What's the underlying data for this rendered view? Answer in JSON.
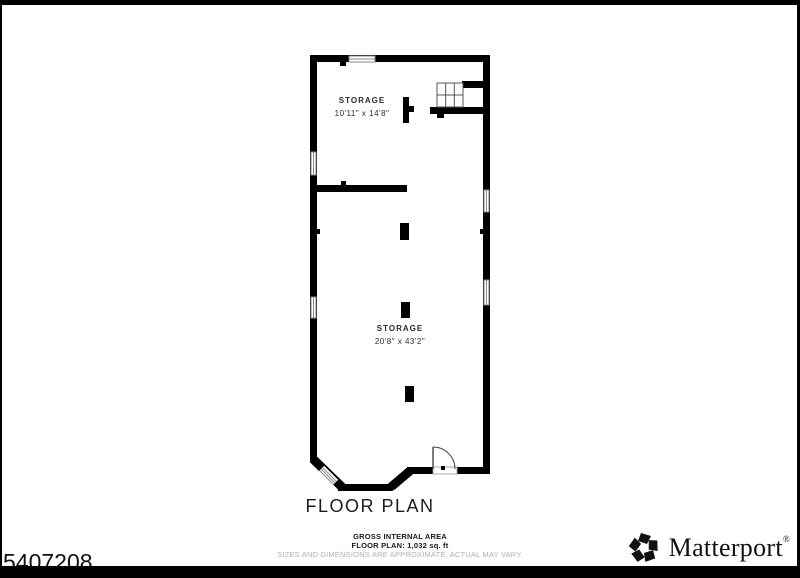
{
  "page": {
    "background": "#ffffff",
    "frame_color": "#000000",
    "wall_color": "#000000"
  },
  "floor_plan": {
    "title": "FLOOR PLAN",
    "rooms": [
      {
        "name": "STORAGE",
        "dimensions": "10'11\" x 14'8\""
      },
      {
        "name": "STORAGE",
        "dimensions": "20'8\" x 43'2\""
      }
    ],
    "symbols": [
      "staircase",
      "door-swing",
      "windows",
      "columns"
    ],
    "footer": {
      "line1": "GROSS INTERNAL AREA",
      "line2": "FLOOR PLAN: 1,032 sq. ft",
      "line3": "SIZES AND DIMENSIONS ARE APPROXIMATE, ACTUAL MAY VARY."
    }
  },
  "watermark": {
    "id_number": "5407208"
  },
  "branding": {
    "logo_text": "Matterport",
    "registered_mark": "®",
    "logo_icon": "matterport-pinwheel-icon"
  }
}
